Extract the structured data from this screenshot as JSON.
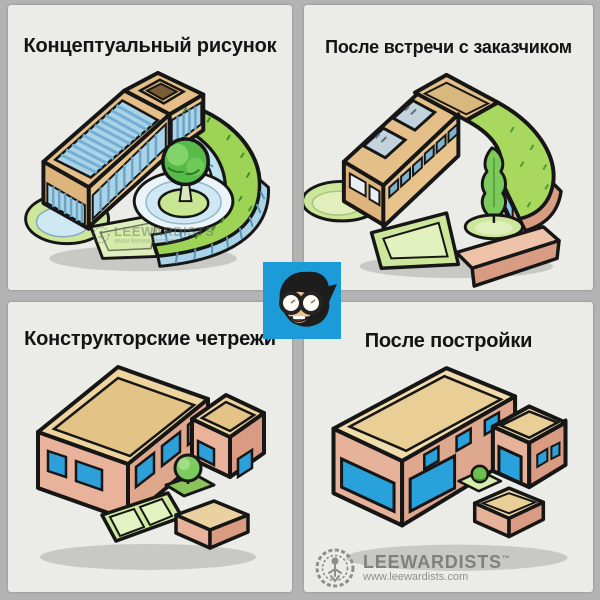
{
  "panels": [
    {
      "title": "Концептуальный рисунок"
    },
    {
      "title": "После встречи с заказчиком"
    },
    {
      "title": "Конструкторские четрежи"
    },
    {
      "title": "После постройки"
    }
  ],
  "watermark": {
    "brand": "LEEWARDISTS",
    "url": "www.leewardists.com"
  },
  "footer": {
    "brand": "LEEWARDISTS",
    "tm": "™",
    "url": "www.leewardists.com"
  },
  "colors": {
    "background": "#b3b3b3",
    "panel_bg": "#ebebe8",
    "title_text": "#141414",
    "avatar_blue": "#1b9cd8",
    "wall_tan": "#e4bf87",
    "roof_cream": "#eed5a0",
    "wall_pink": "#e9b39b",
    "window_blue": "#29a2dc",
    "glass_light": "#a9d4e7",
    "grass_green": "#9ed455",
    "lawn_light": "#cde79a",
    "tree_green": "#57bb49",
    "outline": "#161616",
    "logo_gray": "#7f7f7d"
  }
}
